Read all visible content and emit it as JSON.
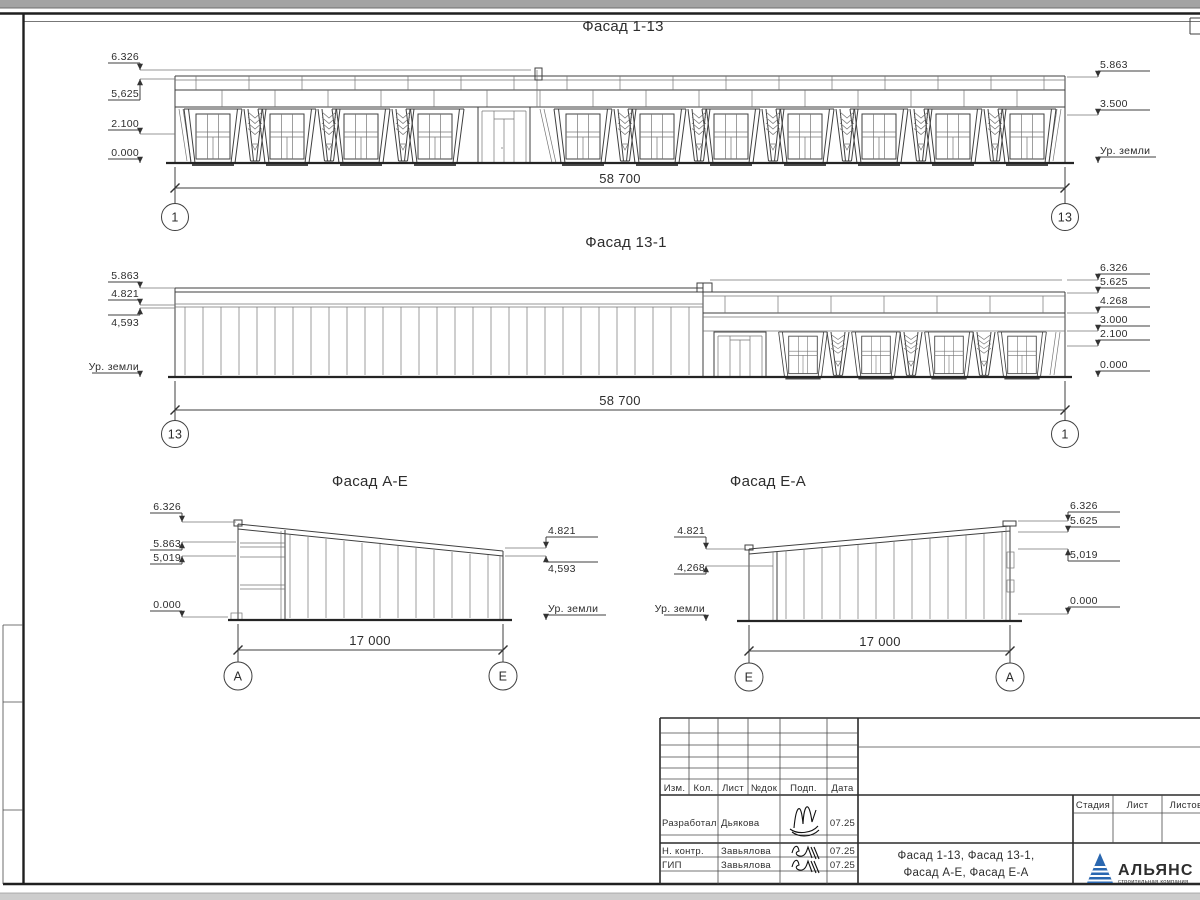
{
  "drawing": {
    "facades": [
      {
        "title": "Фасад 1-13",
        "left_marks": [
          "6.326",
          "5,625",
          "2.100",
          "0.000"
        ],
        "right_marks": [
          "5.863",
          "3.500",
          "Ур. земли"
        ],
        "dimension": "58 700",
        "axis_left": "1",
        "axis_right": "13"
      },
      {
        "title": "Фасад 13-1",
        "left_marks": [
          "5.863",
          "4.821",
          "4,593",
          "Ур. земли"
        ],
        "right_marks": [
          "6.326",
          "5.625",
          "4.268",
          "3.000",
          "2.100",
          "0.000"
        ],
        "dimension": "58 700",
        "axis_left": "13",
        "axis_right": "1"
      },
      {
        "title": "Фасад А-Е",
        "left_marks": [
          "6.326",
          "5.863",
          "5,019",
          "0.000"
        ],
        "right_marks": [
          "4.821",
          "4,593",
          "Ур. земли"
        ],
        "dimension": "17 000",
        "axis_left": "А",
        "axis_right": "Е"
      },
      {
        "title": "Фасад Е-А",
        "left_marks": [
          "4.821",
          "4,268",
          "Ур. земли"
        ],
        "right_marks": [
          "6.326",
          "5.625",
          "5,019",
          "0.000"
        ],
        "dimension": "17 000",
        "axis_left": "Е",
        "axis_right": "А"
      }
    ],
    "title_block": {
      "header_cols": [
        "Изм.",
        "Кол.",
        "Лист",
        "№док",
        "Подп.",
        "Дата"
      ],
      "staff_rows": [
        {
          "role": "Разработал",
          "name": "Дьякова",
          "date": "07.25"
        },
        {
          "role": "Н. контр.",
          "name": "Завьялова",
          "date": "07.25"
        },
        {
          "role": "ГИП",
          "name": "Завьялова",
          "date": "07.25"
        }
      ],
      "sheet_title_line1": "Фасад 1-13, Фасад 13-1,",
      "sheet_title_line2": "Фасад А-Е, Фасад Е-А",
      "stage_cols": [
        "Стадия",
        "Лист",
        "Листов"
      ],
      "logo": {
        "name": "АЛЬЯНС",
        "subtitle": "строительная компания"
      }
    },
    "colors": {
      "line": "#3f3f3f",
      "logo_triangle": "#2a67b0",
      "logo_text": "#17357e",
      "logo_subtitle": "#4a8fd0"
    }
  }
}
